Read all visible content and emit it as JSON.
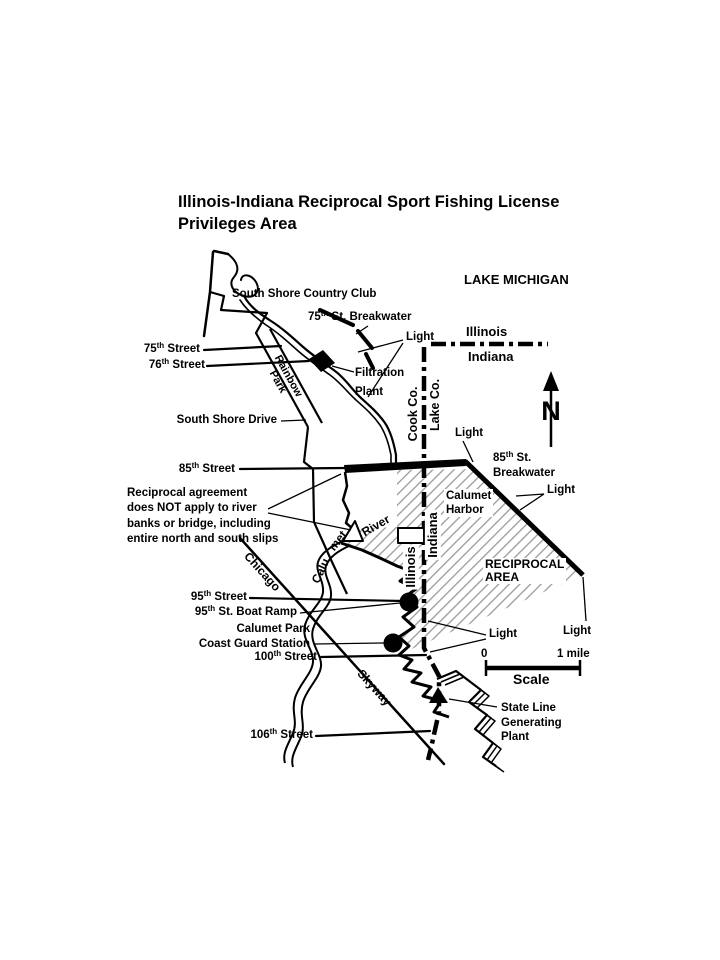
{
  "title": {
    "line1": "Illinois-Indiana Reciprocal Sport Fishing License",
    "line2": "Privileges Area"
  },
  "lake": {
    "name": "LAKE MICHIGAN"
  },
  "boundaries": {
    "state_horizontal": {
      "north_label": "Illinois",
      "south_label": "Indiana"
    },
    "county_vertical": {
      "west_label": "Cook Co.",
      "east_label": "Lake Co."
    },
    "state_vertical": {
      "west_label": "Illinois",
      "east_label": "Indiana"
    }
  },
  "north_arrow": {
    "letter": "N"
  },
  "features": {
    "country_club": "South Shore Country Club",
    "breakwater_75": {
      "pre": "75",
      "sup": "th",
      "post": " St. Breakwater"
    },
    "light": "Light",
    "filtration_plant": {
      "line1": "Filtration",
      "line2": "Plant"
    },
    "rainbow_park": {
      "line1": "Rainbow",
      "line2": "Park"
    },
    "south_shore_drive": "South Shore Drive",
    "breakwater_85": {
      "line1": {
        "pre": "85",
        "sup": "th",
        "post": " St."
      },
      "line2": "Breakwater"
    },
    "calumet_harbor": {
      "line1": "Calumet",
      "line2": "Harbor"
    },
    "reciprocal_area": {
      "line1": "RECIPROCAL",
      "line2": "AREA"
    },
    "calumet_river": {
      "part1": "Calu",
      "part2": "met",
      "part3": "River"
    },
    "chicago_skyway": {
      "part1": "Chicago",
      "part2": "Skyway"
    },
    "coast_guard": {
      "line1": "Calumet Park",
      "line2": "Coast Guard Station"
    },
    "boat_ramp": {
      "pre": "95",
      "sup": "th",
      "post": " St. Boat Ramp"
    },
    "generating_plant": {
      "line1": "State Line",
      "line2": "Generating",
      "line3": "Plant"
    }
  },
  "streets": {
    "s75": {
      "pre": "75",
      "sup": "th",
      "post": " Street"
    },
    "s76": {
      "pre": "76",
      "sup": "th",
      "post": " Street"
    },
    "s85": {
      "pre": "85",
      "sup": "th",
      "post": " Street"
    },
    "s95": {
      "pre": "95",
      "sup": "th",
      "post": " Street"
    },
    "s100": {
      "pre": "100",
      "sup": "th",
      "post": " Street"
    },
    "s106": {
      "pre": "106",
      "sup": "th",
      "post": " Street"
    }
  },
  "note": {
    "line1": "Reciprocal agreement",
    "line2": "does NOT apply to river",
    "line3": "banks or bridge, including",
    "line4": "entire north and south slips"
  },
  "scale": {
    "zero": "0",
    "max": "1 mile",
    "label": "Scale"
  },
  "colors": {
    "ink": "#000000",
    "hatch": "#9a9a9a",
    "background": "#ffffff"
  },
  "icons": {
    "filtration_plant_marker": "black-diamond",
    "boat_ramp_marker": "filled-circle",
    "coast_guard_marker": "filled-circle",
    "generating_plant_marker": "filled-triangle",
    "north_arrow": "arrow-up",
    "boundary_line": "dash-dot-line"
  }
}
